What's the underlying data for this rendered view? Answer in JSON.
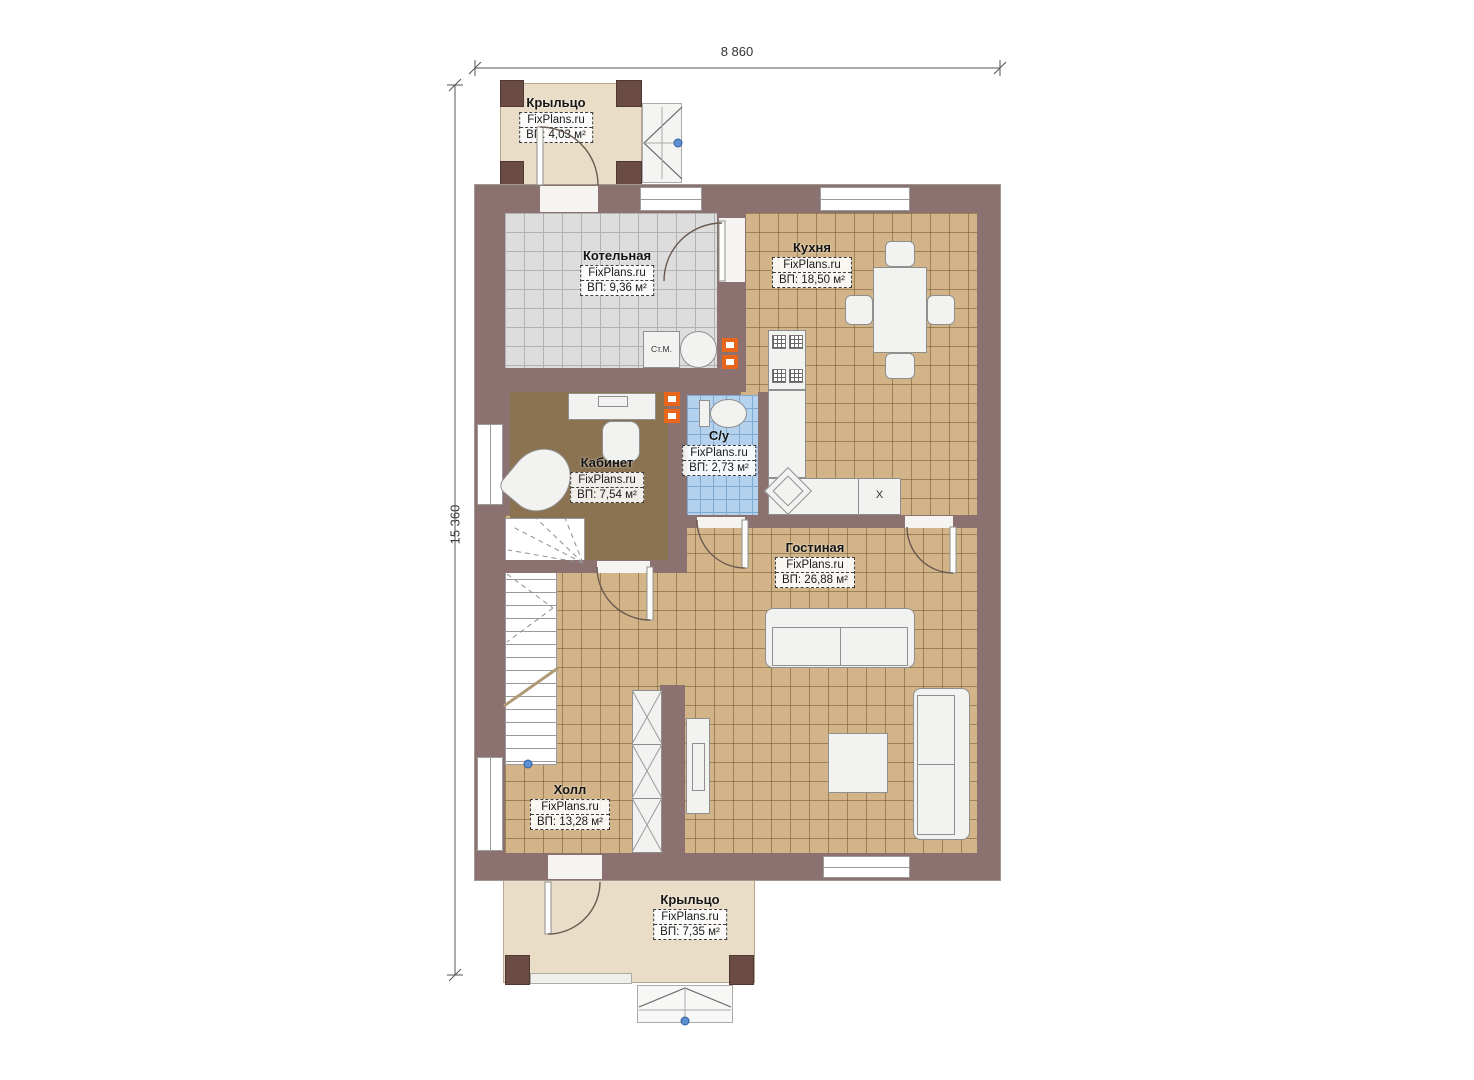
{
  "brand": "FixPlans.ru",
  "dimensions": {
    "width_label": "8 860",
    "height_label": "15 360"
  },
  "rooms": [
    {
      "name": "Крыльцо",
      "area": "ВП: 4,03 м²"
    },
    {
      "name": "Котельная",
      "area": "ВП: 9,36 м²"
    },
    {
      "name": "Кухня",
      "area": "ВП: 18,50 м²"
    },
    {
      "name": "Кабинет",
      "area": "ВП: 7,54 м²"
    },
    {
      "name": "С/у",
      "area": "ВП: 2,73 м²"
    },
    {
      "name": "Гостиная",
      "area": "ВП: 26,88 м²"
    },
    {
      "name": "Холл",
      "area": "ВП: 13,28 м²"
    },
    {
      "name": "Крыльцо",
      "area": "ВП: 7,35 м²"
    }
  ],
  "fixtures": {
    "washing_machine": "Ст.М.",
    "fridge_mark": "X"
  },
  "colors": {
    "wall": "#8b7270",
    "pillar": "#6b4c44",
    "porch_floor": "#eaddc8",
    "tile_gray": "#dddddd",
    "tile_tan": "#d2b488",
    "tile_blue": "#b4d2ee",
    "office_floor": "#8b7351",
    "radiator_accent": "#e8651c",
    "marker_blue": "#5b8fd0"
  }
}
